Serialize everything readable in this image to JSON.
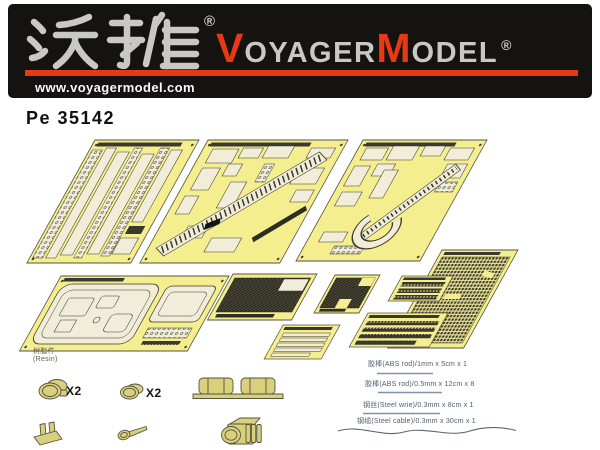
{
  "header": {
    "brand_cn": "沃雅",
    "brand_cn_reg": "®",
    "brand_en_v": "V",
    "brand_en_oyager": "OYAGER",
    "brand_en_m": "M",
    "brand_en_odel": "ODEL",
    "brand_en_reg": "®",
    "url": "www.voyagermodel.com"
  },
  "product_code": "Pe 35142",
  "resin": {
    "label_cn": "树脂件",
    "label_en": "(Resin)",
    "x2_a": "X2",
    "x2_b": "X2"
  },
  "materials": {
    "items": [
      {
        "text": "胶棒(ABS rod)/1mm x 5cm x 1"
      },
      {
        "text": "胶棒(ABS rod)/0.5mm x 12cm x 8"
      },
      {
        "text": "钢丝(Steel wrie)/0.3mm x 8cm x 1"
      },
      {
        "text": "钢缆(Steel cable)/0.3mm x 30cm x 1"
      }
    ]
  },
  "colors": {
    "banner_bg": "#151310",
    "brand_silver": "#c8c9c7",
    "brand_red": "#e83a12",
    "fret_yellow": "#f4ee8e",
    "part_cream": "#f1edd9",
    "resin_khaki": "#d9d07e"
  }
}
